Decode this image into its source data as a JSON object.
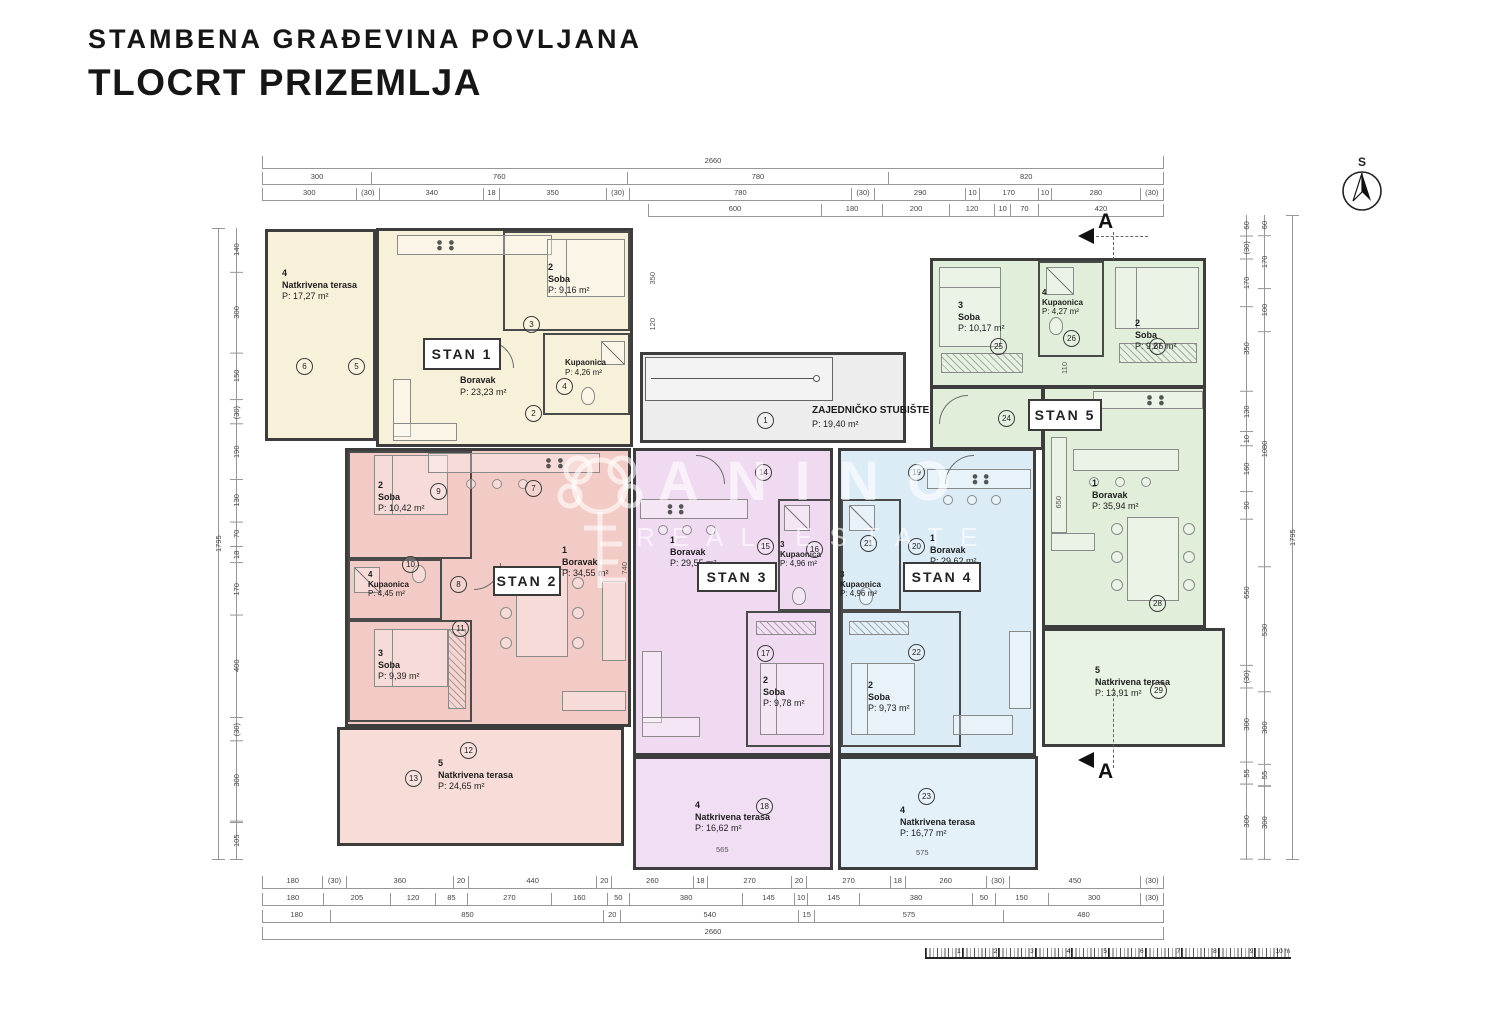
{
  "title": {
    "line1": "STAMBENA GRAĐEVINA POVLJANA",
    "line2": "TLOCRT PRIZEMLJA"
  },
  "watermark": {
    "brand": "ANINO",
    "tagline": "REAL ESTATE"
  },
  "compass": {
    "label": "S"
  },
  "section": {
    "label": "A"
  },
  "common": {
    "stair_name": "ZAJEDNIČKO STUBIŠTE",
    "stair_area": "P: 19,40 m²"
  },
  "colors": {
    "beige": "#f8f1da",
    "pink": "#f3cbc6",
    "pink_light": "#f7dcd8",
    "purple": "#efdaf1",
    "purple_light": "#f2def4",
    "blue": "#dcecf7",
    "blue_light": "#e4f1f9",
    "green": "#e0eeda",
    "green_light": "#e8f3e3",
    "wall": "#3d3d3d"
  },
  "apartments": {
    "stan1": {
      "label": "STAN 1",
      "terrace": {
        "num": "4",
        "name": "Natkrivena terasa",
        "area": "P: 17,27 m²"
      },
      "boravak": {
        "name": "Boravak",
        "area": "P: 23,23 m²"
      },
      "soba": {
        "num": "2",
        "name": "Soba",
        "area": "P: 9,16 m²"
      },
      "kupaonica": {
        "num": "3",
        "name": "Kupaonica",
        "area": "P: 4,26 m²"
      }
    },
    "stan2": {
      "label": "STAN 2",
      "soba2": {
        "num": "2",
        "name": "Soba",
        "area": "P: 10,42 m²"
      },
      "kupaonica": {
        "num": "4",
        "name": "Kupaonica",
        "area": "P: 4,45 m²"
      },
      "soba3": {
        "num": "3",
        "name": "Soba",
        "area": "P: 9,39 m²"
      },
      "boravak": {
        "num": "1",
        "name": "Boravak",
        "area": "P: 34,55 m²"
      },
      "terrace": {
        "num": "5",
        "name": "Natkrivena terasa",
        "area": "P: 24,65 m²"
      }
    },
    "stan3": {
      "label": "STAN 3",
      "boravak": {
        "num": "1",
        "name": "Boravak",
        "area": "P: 29,55 m²"
      },
      "kupaonica": {
        "num": "3",
        "name": "Kupaonica",
        "area": "P: 4,96 m²"
      },
      "soba": {
        "num": "2",
        "name": "Soba",
        "area": "P: 9,78 m²"
      },
      "terrace": {
        "num": "4",
        "name": "Natkrivena terasa",
        "area": "P: 16,62 m²"
      }
    },
    "stan4": {
      "label": "STAN 4",
      "kupaonica": {
        "num": "3",
        "name": "Kupaonica",
        "area": "P: 4,96 m²"
      },
      "boravak": {
        "num": "1",
        "name": "Boravak",
        "area": "P: 29,62 m²"
      },
      "soba": {
        "num": "2",
        "name": "Soba",
        "area": "P: 9,73 m²"
      },
      "terrace": {
        "num": "4",
        "name": "Natkrivena terasa",
        "area": "P: 16,77 m²"
      }
    },
    "stan5": {
      "label": "STAN 5",
      "soba3": {
        "num": "3",
        "name": "Soba",
        "area": "P: 10,17 m²"
      },
      "kupaonica": {
        "num": "4",
        "name": "Kupaonica",
        "area": "P: 4,27 m²"
      },
      "soba2": {
        "num": "2",
        "name": "Soba",
        "area": "P: 9,86 m²"
      },
      "boravak": {
        "num": "1",
        "name": "Boravak",
        "area": "P: 35,94 m²"
      },
      "terrace": {
        "num": "5",
        "name": "Natkrivena terasa",
        "area": "P: 13,91 m²"
      }
    }
  },
  "circles": {
    "c1": "1",
    "c2": "2",
    "c3": "3",
    "c4": "4",
    "c5": "5",
    "c6": "6",
    "c7": "7",
    "c8": "8",
    "c9": "9",
    "c10": "10",
    "c11": "11",
    "c12": "12",
    "c13": "13",
    "c14": "14",
    "c15": "15",
    "c16": "16",
    "c17": "17",
    "c18": "18",
    "c19": "19",
    "c20": "20",
    "c21": "21",
    "c22": "22",
    "c23": "23",
    "c24": "24",
    "c25": "25",
    "c26": "26",
    "c27": "27",
    "c28": "28",
    "c29": "29"
  },
  "dims": {
    "top": {
      "total": [
        {
          "t": "2660",
          "w": 1
        }
      ],
      "row2": [
        {
          "t": "300",
          "w": 300
        },
        {
          "t": "760",
          "w": 760
        },
        {
          "t": "780",
          "w": 780
        },
        {
          "t": "820",
          "w": 820
        }
      ],
      "row3": [
        {
          "t": "300",
          "w": 300
        },
        {
          "t": "(30)",
          "w": 34
        },
        {
          "t": "340",
          "w": 340
        },
        {
          "t": "18",
          "w": 22
        },
        {
          "t": "350",
          "w": 350
        },
        {
          "t": "(30)",
          "w": 34
        },
        {
          "t": "780",
          "w": 780
        },
        {
          "t": "(30)",
          "w": 34
        },
        {
          "t": "290",
          "w": 290
        },
        {
          "t": "10",
          "w": 16
        },
        {
          "t": "170",
          "w": 170
        },
        {
          "t": "10",
          "w": 16
        },
        {
          "t": "280",
          "w": 280
        },
        {
          "t": "(30)",
          "w": 34
        }
      ],
      "row4": [
        {
          "t": "600",
          "w": 600
        },
        {
          "t": "180",
          "w": 180
        },
        {
          "t": "200",
          "w": 200
        },
        {
          "t": "120",
          "w": 120
        },
        {
          "t": "10",
          "w": 24
        },
        {
          "t": "70",
          "w": 70
        },
        {
          "t": "420",
          "w": 420
        }
      ]
    },
    "bottom": {
      "row1": [
        {
          "t": "180",
          "w": 180
        },
        {
          "t": "(30)",
          "w": 34
        },
        {
          "t": "360",
          "w": 360
        },
        {
          "t": "20",
          "w": 22
        },
        {
          "t": "440",
          "w": 440
        },
        {
          "t": "20",
          "w": 22
        },
        {
          "t": "260",
          "w": 260
        },
        {
          "t": "18",
          "w": 20
        },
        {
          "t": "270",
          "w": 270
        },
        {
          "t": "20",
          "w": 22
        },
        {
          "t": "270",
          "w": 270
        },
        {
          "t": "18",
          "w": 20
        },
        {
          "t": "260",
          "w": 260
        },
        {
          "t": "(30)",
          "w": 34
        },
        {
          "t": "450",
          "w": 450
        },
        {
          "t": "(30)",
          "w": 34
        }
      ],
      "row2": [
        {
          "t": "180",
          "w": 180
        },
        {
          "t": "205",
          "w": 205
        },
        {
          "t": "120",
          "w": 120
        },
        {
          "t": "85",
          "w": 85
        },
        {
          "t": "270",
          "w": 270
        },
        {
          "t": "160",
          "w": 160
        },
        {
          "t": "50",
          "w": 50
        },
        {
          "t": "380",
          "w": 380
        },
        {
          "t": "145",
          "w": 145
        },
        {
          "t": "10",
          "w": 16
        },
        {
          "t": "145",
          "w": 145
        },
        {
          "t": "380",
          "w": 380
        },
        {
          "t": "50",
          "w": 50
        },
        {
          "t": "150",
          "w": 150
        },
        {
          "t": "300",
          "w": 300
        },
        {
          "t": "(30)",
          "w": 34
        }
      ],
      "row3": [
        {
          "t": "180",
          "w": 180
        },
        {
          "t": "850",
          "w": 850
        },
        {
          "t": "20",
          "w": 24
        },
        {
          "t": "540",
          "w": 540
        },
        {
          "t": "15",
          "w": 20
        },
        {
          "t": "575",
          "w": 575
        },
        {
          "t": "480",
          "w": 480
        }
      ],
      "total": [
        {
          "t": "2660",
          "w": 1
        }
      ]
    },
    "left": {
      "total": [
        {
          "t": "1795",
          "w": 1
        }
      ],
      "col": [
        {
          "t": "140",
          "w": 140
        },
        {
          "t": "300",
          "w": 300
        },
        {
          "t": "150",
          "w": 150
        },
        {
          "t": "(30)",
          "w": 40
        },
        {
          "t": "190",
          "w": 190
        },
        {
          "t": "130",
          "w": 130
        },
        {
          "t": "70",
          "w": 70
        },
        {
          "t": "18",
          "w": 30
        },
        {
          "t": "170",
          "w": 170
        },
        {
          "t": "400",
          "w": 400
        },
        {
          "t": "(30)",
          "w": 40
        },
        {
          "t": "300",
          "w": 300
        },
        {
          "t": "105",
          "w": 105
        }
      ]
    },
    "right": {
      "total": [
        {
          "t": "1795",
          "w": 1
        }
      ],
      "col1": [
        {
          "t": "60",
          "w": 60
        },
        {
          "t": "(30)",
          "w": 40
        },
        {
          "t": "170",
          "w": 170
        },
        {
          "t": "350",
          "w": 350
        },
        {
          "t": "130",
          "w": 130
        },
        {
          "t": "10",
          "w": 24
        },
        {
          "t": "160",
          "w": 160
        },
        {
          "t": "90",
          "w": 90
        },
        {
          "t": "650",
          "w": 650
        },
        {
          "t": "(30)",
          "w": 40
        },
        {
          "t": "300",
          "w": 300
        },
        {
          "t": "55",
          "w": 60
        },
        {
          "t": "300",
          "w": 300
        }
      ],
      "col2": [
        {
          "t": "60",
          "w": 60
        },
        {
          "t": "170",
          "w": 200
        },
        {
          "t": "100",
          "w": 150
        },
        {
          "t": "1080",
          "w": 1100
        },
        {
          "t": "530",
          "w": 560
        },
        {
          "t": "300",
          "w": 300
        },
        {
          "t": "55",
          "w": 60
        },
        {
          "t": "300",
          "w": 300
        }
      ]
    },
    "inner": {
      "a": "350",
      "b": "120",
      "c": "110",
      "d": "740",
      "e": "650",
      "f": "565",
      "g": "575"
    }
  },
  "scalebar": {
    "labels": [
      {
        "t": "1"
      },
      {
        "t": "2"
      },
      {
        "t": "3"
      },
      {
        "t": "4"
      },
      {
        "t": "5"
      },
      {
        "t": "6"
      },
      {
        "t": "7"
      },
      {
        "t": "8"
      },
      {
        "t": "9"
      },
      {
        "t": "10 m"
      }
    ]
  }
}
